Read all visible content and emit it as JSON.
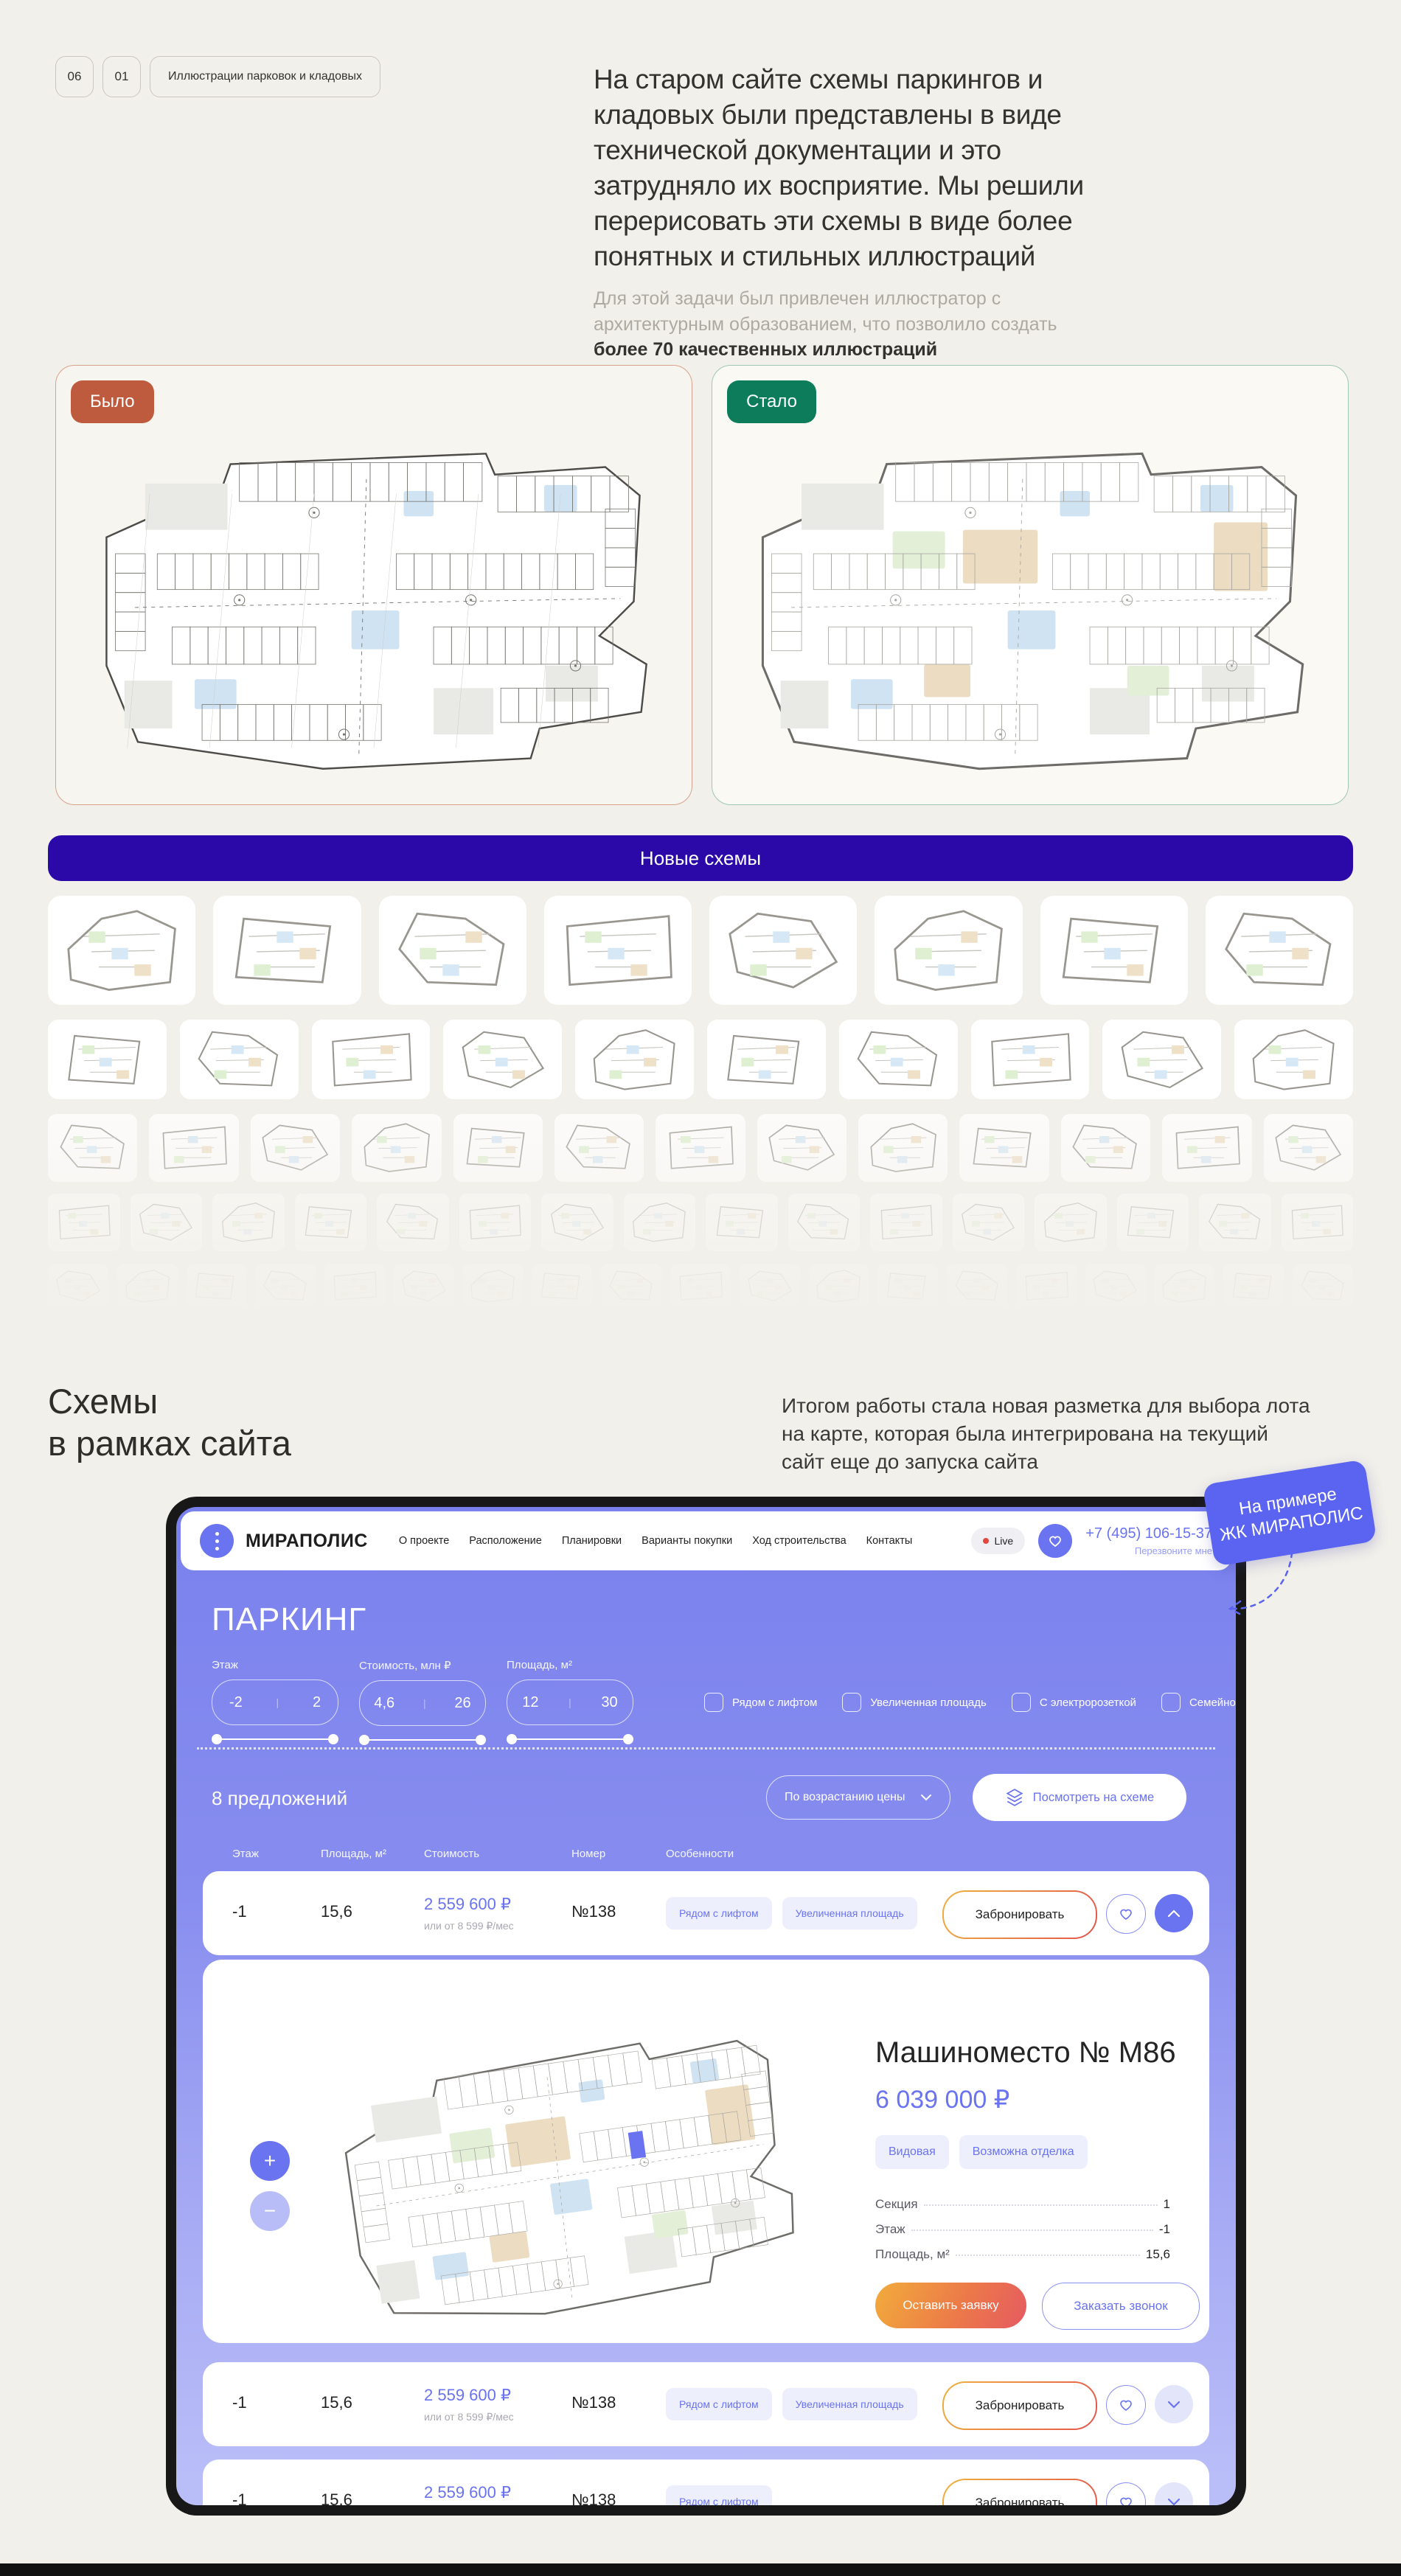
{
  "intro": {
    "num1": "06",
    "num2": "01",
    "tag": "Иллюстрации парковок и кладовых",
    "lead": "На старом сайте схемы паркингов и кладовых были представлены в виде технической документации и это затрудняло их восприятие. Мы решили перерисовать эти схемы в виде более понятных и стильных иллюстраций",
    "note_gray": "Для этой задачи был привлечен иллюстратор с архитектурным образованием, что позволило создать ",
    "note_dark": "более 70 качественных иллюстраций"
  },
  "compare": {
    "was": "Было",
    "became": "Стало"
  },
  "banner": {
    "label": "Новые схемы"
  },
  "grid": {
    "rows": [
      8,
      10,
      13,
      16,
      19
    ]
  },
  "site_intro": {
    "heading1": "Схемы",
    "heading2": "в  рамках сайта",
    "paragraph": "Итогом работы стала новая разметка для выбора лота на карте, которая была интегрирована на текущий сайт еще до запуска сайта",
    "sticker1": "На примере",
    "sticker2": "ЖК МИРАПОЛИС"
  },
  "site": {
    "brand": "МИРАПОЛИС",
    "nav": [
      "О проекте",
      "Расположение",
      "Планировки",
      "Варианты покупки",
      "Ход строительства",
      "Контакты"
    ],
    "live": "Live",
    "phone": "+7 (495) 106-15-37",
    "callback": "Перезвоните мне",
    "title": "ПАРКИНГ",
    "filters": {
      "floor_label": "Этаж",
      "floor_min": "-2",
      "floor_max": "2",
      "price_label": "Стоимость, млн ₽",
      "price_min": "4,6",
      "price_max": "26",
      "area_label": "Площадь, м²",
      "area_min": "12",
      "area_max": "30",
      "checks": [
        "Рядом с лифтом",
        "Увеличенная площадь",
        "С электророзеткой",
        "Семейное"
      ]
    },
    "offers_count": "8 предложений",
    "sort_label": "По возрастанию цены",
    "scheme_button": "Посмотреть на схеме",
    "columns": [
      "Этаж",
      "Площадь, м²",
      "Стоимость",
      "Номер",
      "Особенности"
    ],
    "book_label": "Забронировать",
    "rows": [
      {
        "floor": "-1",
        "area": "15,6",
        "price": "2 559 600 ₽",
        "monthly": "или от 8 599 ₽/мес",
        "number": "№138",
        "tags": [
          "Рядом с лифтом",
          "Увеличенная площадь"
        ],
        "expanded": true
      },
      {
        "floor": "-1",
        "area": "15,6",
        "price": "2 559 600 ₽",
        "monthly": "или от 8 599 ₽/мес",
        "number": "№138",
        "tags": [
          "Рядом с лифтом",
          "Увеличенная площадь"
        ],
        "expanded": false
      },
      {
        "floor": "-1",
        "area": "15,6",
        "price": "2 559 600 ₽",
        "monthly": "или от 8 599 ₽/мес",
        "number": "№138",
        "tags": [
          "Рядом с лифтом"
        ],
        "expanded": false
      }
    ],
    "detail": {
      "title": "Машиноместо № М86",
      "price": "6 039 000 ₽",
      "tags": [
        "Видовая",
        "Возможна отделка"
      ],
      "specs": [
        [
          "Секция",
          "1"
        ],
        [
          "Этаж",
          "-1"
        ],
        [
          "Площадь, м²",
          "15,6"
        ]
      ],
      "cta_primary": "Оставить заявку",
      "cta_secondary": "Заказать звонок"
    }
  },
  "colors": {
    "accent": "#6A73F0",
    "banner_bg": "#2B09A8",
    "was_badge": "#BE5B3E",
    "became_badge": "#0C7C5A",
    "sticker_bg": "#5A64F1",
    "page_bg": "#F2F0EA"
  }
}
